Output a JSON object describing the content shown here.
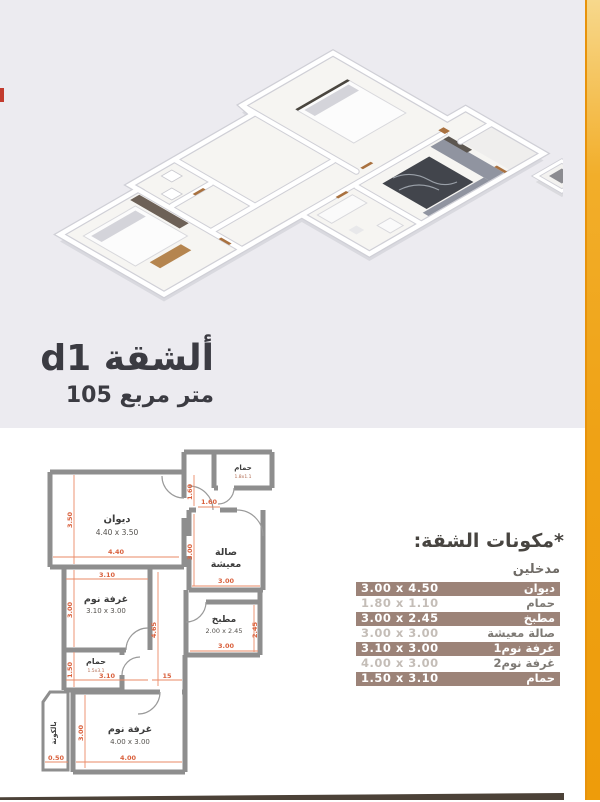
{
  "title": {
    "name": "ألشقة d1",
    "area": "105 متر مربع"
  },
  "components": {
    "title": "*مكونات الشقة:",
    "entrances": "مدخلين",
    "rows": [
      {
        "name": "ديوان",
        "dims": "3.00 x 4.50"
      },
      {
        "name": "حمام",
        "dims": "1.80 x 1.10"
      },
      {
        "name": "مطبخ",
        "dims": "3.00 x 2.45"
      },
      {
        "name": "صالة معيشة",
        "dims": "3.00 x 3.00"
      },
      {
        "name": "غرفة نوم1",
        "dims": "3.10 x 3.00"
      },
      {
        "name": "غرفة نوم2",
        "dims": "4.00 x 3.00"
      },
      {
        "name": "حمام",
        "dims": "1.50 x 3.10"
      }
    ]
  },
  "plan": {
    "rooms": {
      "diwan": {
        "name": "ديوان",
        "dims": "4.40 x 3.50"
      },
      "living1": "صالة",
      "living2": "معيشة",
      "bed1": {
        "name": "غرفة نوم",
        "dims": "3.10 x 3.00"
      },
      "kitchen": {
        "name": "مطبخ",
        "dims": "2.00 x 2.45"
      },
      "bath_small": {
        "name": "حمام",
        "dims": "1.5x3.1"
      },
      "bed2": {
        "name": "غرفة نوم",
        "dims": "4.00 x 3.00"
      },
      "balcony": {
        "name": "بالكونة"
      },
      "bath_top": {
        "name": "حمام",
        "dims": "1.8x1.1"
      }
    },
    "dims": {
      "d350": "3.50",
      "d440": "4.40",
      "d310": "3.10",
      "d300": "3.00",
      "d150": "1.50",
      "d15": "15",
      "d465": "4.65",
      "d400": "4.00",
      "d050": "0.50",
      "d160": "1.60",
      "d245": "2.45"
    }
  },
  "colors": {
    "accent": "#efa215",
    "row_dark": "#9c8378",
    "dim_line": "#e06745",
    "wall": "#8e8e8e"
  }
}
